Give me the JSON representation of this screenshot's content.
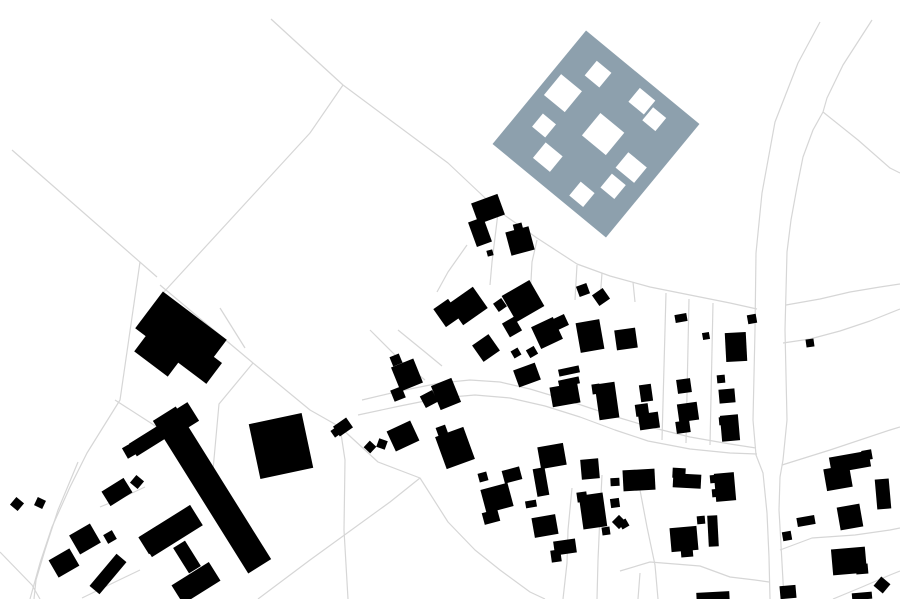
{
  "map": {
    "kind": "architectural-figure-ground-site-plan",
    "canvas": {
      "width": 900,
      "height": 599
    },
    "colors": {
      "background": "#ffffff",
      "parcel_line": "#d6d6d6",
      "building": "#000000",
      "proposed_site": "#8da0ad",
      "courtyard": "#ffffff"
    },
    "proposed_site": {
      "cx": 596,
      "cy": 134,
      "size": 147,
      "rotation": 39.5,
      "courtyards": [
        [
          8.5,
          49.5,
          27,
          27
        ],
        [
          27.5,
          16.5,
          19,
          19
        ],
        [
          78,
          10,
          20,
          18
        ],
        [
          100.5,
          16.5,
          17,
          17
        ],
        [
          63.5,
          54.5,
          31,
          29
        ],
        [
          19.5,
          91.5,
          17,
          17
        ],
        [
          40,
          112,
          22,
          20
        ],
        [
          92,
          120,
          18,
          18
        ],
        [
          111,
          94,
          18,
          18
        ],
        [
          110,
          67,
          24,
          20
        ]
      ]
    },
    "buildings": [
      [
        181,
        334,
        80,
        46,
        37
      ],
      [
        160,
        352,
        42,
        30,
        37
      ],
      [
        199,
        362,
        38,
        26,
        37
      ],
      [
        212,
        490,
        27,
        180,
        -32
      ],
      [
        178,
        421,
        36,
        22,
        -32
      ],
      [
        149,
        440,
        38,
        15,
        -32
      ],
      [
        171,
        531,
        60,
        24,
        -32
      ],
      [
        153,
        540,
        22,
        20,
        -32
      ],
      [
        187,
        557,
        14,
        30,
        -32
      ],
      [
        196,
        583,
        44,
        22,
        -32
      ],
      [
        281,
        446,
        54,
        56,
        -12
      ],
      [
        131,
        450,
        14,
        12,
        -30
      ],
      [
        137,
        482,
        10,
        10,
        40
      ],
      [
        117,
        492,
        26,
        17,
        -32
      ],
      [
        17,
        504,
        10,
        10,
        40
      ],
      [
        40,
        503,
        9,
        9,
        25
      ],
      [
        85,
        539,
        24,
        22,
        -30
      ],
      [
        110,
        537,
        10,
        10,
        -30
      ],
      [
        64,
        563,
        24,
        20,
        -30
      ],
      [
        108,
        574,
        13,
        42,
        40
      ],
      [
        343,
        427,
        16,
        12,
        -35
      ],
      [
        336,
        432,
        8,
        8,
        -35
      ],
      [
        370,
        447,
        9,
        9,
        43
      ],
      [
        382,
        444,
        9,
        9,
        20
      ],
      [
        488,
        209,
        28,
        22,
        -20
      ],
      [
        480,
        232,
        16,
        26,
        -20
      ],
      [
        520,
        241,
        24,
        24,
        -15
      ],
      [
        518,
        227,
        9,
        7,
        -15
      ],
      [
        490,
        253,
        6,
        6,
        -15
      ],
      [
        447,
        313,
        18,
        22,
        -35
      ],
      [
        468,
        306,
        30,
        26,
        -35
      ],
      [
        500,
        305,
        10,
        10,
        -35
      ],
      [
        523,
        301,
        32,
        30,
        -30
      ],
      [
        512,
        327,
        14,
        16,
        -30
      ],
      [
        547,
        333,
        24,
        24,
        -25
      ],
      [
        561,
        322,
        12,
        12,
        -25
      ],
      [
        486,
        348,
        20,
        20,
        -35
      ],
      [
        516,
        353,
        8,
        8,
        -30
      ],
      [
        532,
        352,
        9,
        9,
        -30
      ],
      [
        527,
        375,
        23,
        18,
        -20
      ],
      [
        583,
        290,
        11,
        11,
        -20
      ],
      [
        601,
        297,
        13,
        13,
        -35
      ],
      [
        590,
        336,
        24,
        30,
        -10
      ],
      [
        626,
        339,
        21,
        20,
        -8
      ],
      [
        681,
        318,
        12,
        8,
        -10
      ],
      [
        706,
        336,
        7,
        7,
        -10
      ],
      [
        752,
        319,
        9,
        9,
        -10
      ],
      [
        736,
        347,
        21,
        29,
        -3
      ],
      [
        721,
        379,
        8,
        8,
        -5
      ],
      [
        727,
        396,
        16,
        14,
        -5
      ],
      [
        684,
        386,
        14,
        14,
        -8
      ],
      [
        688,
        412,
        20,
        18,
        -8
      ],
      [
        683,
        427,
        14,
        12,
        -8
      ],
      [
        646,
        393,
        12,
        17,
        -8
      ],
      [
        642,
        410,
        13,
        12,
        -8
      ],
      [
        649,
        421,
        20,
        16,
        -8
      ],
      [
        810,
        343,
        8,
        8,
        -8
      ],
      [
        407,
        375,
        24,
        26,
        -22
      ],
      [
        396,
        360,
        10,
        10,
        -22
      ],
      [
        398,
        394,
        12,
        12,
        -22
      ],
      [
        429,
        399,
        14,
        13,
        -28
      ],
      [
        446,
        394,
        22,
        26,
        -22
      ],
      [
        403,
        436,
        26,
        22,
        -25
      ],
      [
        455,
        448,
        30,
        34,
        -20
      ],
      [
        442,
        431,
        10,
        10,
        -20
      ],
      [
        483,
        477,
        9,
        9,
        -15
      ],
      [
        512,
        475,
        18,
        13,
        -15
      ],
      [
        497,
        498,
        28,
        24,
        -15
      ],
      [
        491,
        517,
        16,
        12,
        -15
      ],
      [
        531,
        504,
        11,
        7,
        -10
      ],
      [
        552,
        456,
        26,
        22,
        -10
      ],
      [
        541,
        482,
        12,
        28,
        -10
      ],
      [
        545,
        526,
        24,
        20,
        -10
      ],
      [
        565,
        547,
        22,
        14,
        -8
      ],
      [
        556,
        556,
        10,
        12,
        -8
      ],
      [
        569,
        371,
        21,
        7,
        -12
      ],
      [
        569,
        382,
        21,
        7,
        -12
      ],
      [
        565,
        395,
        28,
        20,
        -10
      ],
      [
        607,
        401,
        20,
        36,
        -8
      ],
      [
        596,
        389,
        8,
        10,
        -8
      ],
      [
        590,
        469,
        18,
        20,
        -5
      ],
      [
        639,
        480,
        32,
        21,
        -3
      ],
      [
        615,
        482,
        9,
        8,
        -3
      ],
      [
        687,
        481,
        28,
        14,
        3
      ],
      [
        679,
        473,
        13,
        10,
        3
      ],
      [
        725,
        487,
        20,
        28,
        -5
      ],
      [
        714,
        479,
        8,
        8,
        -5
      ],
      [
        716,
        493,
        8,
        8,
        -5
      ],
      [
        730,
        428,
        18,
        26,
        -5
      ],
      [
        723,
        421,
        8,
        8,
        -5
      ],
      [
        701,
        520,
        8,
        8,
        -5
      ],
      [
        713,
        531,
        10,
        31,
        -3
      ],
      [
        684,
        539,
        27,
        24,
        -5
      ],
      [
        687,
        553,
        12,
        8,
        -5
      ],
      [
        593,
        511,
        24,
        34,
        -8
      ],
      [
        582,
        497,
        10,
        10,
        -8
      ],
      [
        615,
        503,
        9,
        9,
        -8
      ],
      [
        619,
        522,
        10,
        10,
        45
      ],
      [
        606,
        531,
        8,
        8,
        -8
      ],
      [
        624,
        524,
        8,
        8,
        -30
      ],
      [
        713,
        597,
        33,
        10,
        -3
      ],
      [
        850,
        462,
        40,
        16,
        -10
      ],
      [
        838,
        478,
        26,
        22,
        -10
      ],
      [
        867,
        455,
        10,
        10,
        -10
      ],
      [
        883,
        494,
        14,
        30,
        -5
      ],
      [
        850,
        517,
        23,
        23,
        -10
      ],
      [
        806,
        521,
        18,
        9,
        -10
      ],
      [
        787,
        536,
        9,
        9,
        -10
      ],
      [
        849,
        561,
        34,
        26,
        -5
      ],
      [
        862,
        569,
        12,
        10,
        -5
      ],
      [
        788,
        592,
        16,
        13,
        -5
      ],
      [
        882,
        585,
        12,
        12,
        40
      ],
      [
        862,
        596,
        20,
        7,
        -5
      ]
    ],
    "parcel_lines": [
      [
        271,
        19,
        343,
        85
      ],
      [
        343,
        85,
        448,
        163,
        500,
        212,
        537,
        238,
        577,
        264,
        610,
        276,
        650,
        287,
        700,
        297,
        730,
        303,
        757,
        309
      ],
      [
        343,
        85,
        310,
        133,
        163,
        293
      ],
      [
        12,
        150,
        157,
        277
      ],
      [
        140,
        262,
        120,
        400,
        87,
        453,
        70,
        487,
        52,
        527,
        40,
        563,
        30,
        599
      ],
      [
        160,
        285,
        253,
        363,
        310,
        410,
        340,
        427
      ],
      [
        340,
        427,
        345,
        460,
        344,
        530,
        348,
        599
      ],
      [
        340,
        427,
        378,
        462,
        420,
        478,
        448,
        522,
        475,
        550,
        500,
        570,
        530,
        592,
        545,
        599
      ],
      [
        362,
        400,
        400,
        391,
        440,
        383,
        470,
        380,
        500,
        382,
        530,
        389,
        560,
        398,
        590,
        408,
        620,
        418,
        650,
        427,
        690,
        437,
        730,
        444,
        756,
        448
      ],
      [
        358,
        415,
        400,
        406,
        440,
        398,
        475,
        395,
        510,
        398,
        545,
        406,
        580,
        417,
        615,
        430,
        648,
        441,
        690,
        449,
        730,
        453,
        757,
        454
      ],
      [
        820,
        22,
        798,
        63,
        775,
        122,
        762,
        193,
        756,
        253,
        755,
        330,
        753,
        420,
        756,
        455,
        763,
        473,
        767,
        513,
        769,
        557,
        770,
        599
      ],
      [
        872,
        20,
        843,
        65,
        827,
        98,
        823,
        112,
        813,
        130,
        803,
        157,
        797,
        187,
        791,
        220,
        787,
        252,
        785,
        330,
        787,
        420,
        783,
        460,
        780,
        477,
        779,
        510,
        781,
        545,
        784,
        599
      ],
      [
        823,
        112,
        858,
        140,
        890,
        168,
        900,
        173
      ],
      [
        786,
        305,
        820,
        299,
        850,
        292,
        880,
        287,
        900,
        284
      ],
      [
        783,
        343,
        810,
        339,
        840,
        331,
        870,
        321,
        900,
        309
      ],
      [
        498,
        213,
        492,
        262,
        490,
        285
      ],
      [
        537,
        240,
        532,
        262,
        530,
        300
      ],
      [
        577,
        265,
        575,
        300
      ],
      [
        602,
        273,
        600,
        300
      ],
      [
        633,
        282,
        635,
        302
      ],
      [
        467,
        245,
        448,
        272,
        437,
        292
      ],
      [
        666,
        293,
        662,
        440
      ],
      [
        689,
        299,
        686,
        443
      ],
      [
        713,
        303,
        710,
        445
      ],
      [
        572,
        488,
        568,
        530,
        567,
        563,
        563,
        599
      ],
      [
        602,
        475,
        600,
        515,
        598,
        560,
        597,
        599
      ],
      [
        640,
        490,
        647,
        527,
        655,
        565,
        658,
        599
      ],
      [
        620,
        571,
        650,
        562,
        700,
        566,
        730,
        577,
        755,
        580,
        769,
        582
      ],
      [
        640,
        573,
        638,
        599
      ],
      [
        253,
        363,
        219,
        404,
        213,
        470,
        215,
        500
      ],
      [
        258,
        599,
        310,
        560,
        350,
        531,
        390,
        502,
        420,
        478
      ],
      [
        115,
        400,
        143,
        418,
        157,
        427
      ],
      [
        0,
        552,
        32,
        585,
        40,
        599
      ],
      [
        78,
        462,
        58,
        510,
        45,
        550,
        36,
        580,
        34,
        599
      ],
      [
        145,
        487,
        117,
        500,
        100,
        507
      ],
      [
        82,
        598,
        115,
        582,
        140,
        570
      ],
      [
        782,
        465,
        830,
        450,
        890,
        430,
        900,
        427
      ],
      [
        780,
        550,
        812,
        538,
        855,
        535,
        890,
        530,
        900,
        528
      ],
      [
        833,
        599,
        862,
        587,
        890,
        575,
        900,
        571
      ],
      [
        220,
        308,
        245,
        348
      ],
      [
        370,
        330,
        400,
        360,
        425,
        380
      ],
      [
        398,
        330,
        425,
        352,
        442,
        366
      ]
    ]
  }
}
